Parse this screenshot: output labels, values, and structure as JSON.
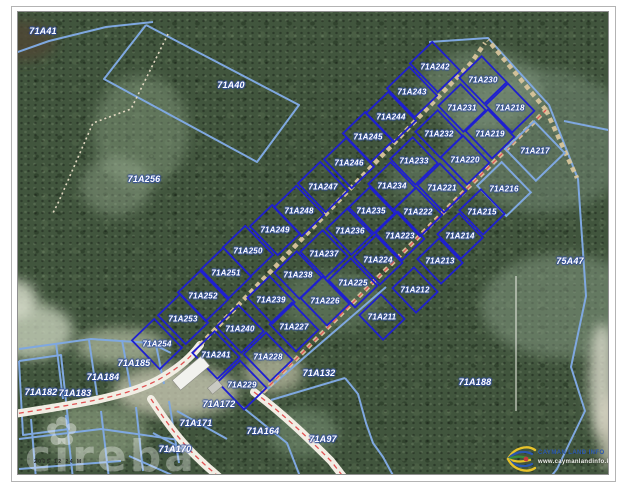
{
  "map": {
    "watermark_text": "cireba",
    "watermark_flower_icon": "flower-icon",
    "scale_text": "2005 12 24  M",
    "logo": {
      "line1": "CAYMAN LAND INFO",
      "line2": "www.caymanlandinfo.ky"
    },
    "colors": {
      "lot_blue": "#1f1fd0",
      "parcel_light_blue": "#7fa8e0",
      "road_white": "#f1eee4",
      "road_red": "#e05353",
      "track_tan": "#d8c59c",
      "label_white": "#ffffff"
    },
    "background_parcels": [
      {
        "id": "71A41",
        "x": 42,
        "y": 30
      },
      {
        "id": "71A40",
        "x": 230,
        "y": 84
      },
      {
        "id": "71A256",
        "x": 143,
        "y": 178
      },
      {
        "id": "75A47",
        "x": 569,
        "y": 260
      },
      {
        "id": "71A132",
        "x": 318,
        "y": 372
      },
      {
        "id": "71A188",
        "x": 474,
        "y": 381
      },
      {
        "id": "71A97",
        "x": 322,
        "y": 438
      },
      {
        "id": "71A185",
        "x": 133,
        "y": 362
      },
      {
        "id": "71A184",
        "x": 102,
        "y": 376
      },
      {
        "id": "71A183",
        "x": 74,
        "y": 392
      },
      {
        "id": "71A182",
        "x": 40,
        "y": 391
      },
      {
        "id": "71A172",
        "x": 218,
        "y": 403
      },
      {
        "id": "71A171",
        "x": 195,
        "y": 422
      },
      {
        "id": "71A170",
        "x": 174,
        "y": 448
      },
      {
        "id": "71A164",
        "x": 262,
        "y": 430
      }
    ],
    "subdivision": {
      "rotation_deg": -44,
      "row_sizes": {
        "1": {
          "w": 31,
          "h": 40
        },
        "2": {
          "w": 31,
          "h": 36
        },
        "3": {
          "w": 31,
          "h": 38
        },
        "4": {
          "w": 30,
          "h": 34
        }
      },
      "lots": [
        {
          "id": "71A242",
          "x": 434,
          "y": 66,
          "row": 1
        },
        {
          "id": "71A243",
          "x": 411,
          "y": 91,
          "row": 1
        },
        {
          "id": "71A244",
          "x": 390,
          "y": 116,
          "row": 1
        },
        {
          "id": "71A245",
          "x": 367,
          "y": 136,
          "row": 1
        },
        {
          "id": "71A246",
          "x": 348,
          "y": 162,
          "row": 1
        },
        {
          "id": "71A247",
          "x": 322,
          "y": 186,
          "row": 1
        },
        {
          "id": "71A248",
          "x": 298,
          "y": 210,
          "row": 1
        },
        {
          "id": "71A249",
          "x": 274,
          "y": 229,
          "row": 1
        },
        {
          "id": "71A250",
          "x": 247,
          "y": 250,
          "row": 1
        },
        {
          "id": "71A251",
          "x": 225,
          "y": 272,
          "row": 1
        },
        {
          "id": "71A252",
          "x": 202,
          "y": 295,
          "row": 1
        },
        {
          "id": "71A253",
          "x": 182,
          "y": 318,
          "row": 1
        },
        {
          "id": "71A254",
          "x": 156,
          "y": 343,
          "row": 1
        },
        {
          "id": "71A230",
          "x": 482,
          "y": 79,
          "row": 2
        },
        {
          "id": "71A231",
          "x": 461,
          "y": 107,
          "row": 2
        },
        {
          "id": "71A232",
          "x": 438,
          "y": 133,
          "row": 2
        },
        {
          "id": "71A233",
          "x": 413,
          "y": 160,
          "row": 2
        },
        {
          "id": "71A234",
          "x": 391,
          "y": 185,
          "row": 2
        },
        {
          "id": "71A235",
          "x": 370,
          "y": 210,
          "row": 2
        },
        {
          "id": "71A236",
          "x": 349,
          "y": 230,
          "row": 2
        },
        {
          "id": "71A237",
          "x": 323,
          "y": 253,
          "row": 2
        },
        {
          "id": "71A238",
          "x": 297,
          "y": 274,
          "row": 2
        },
        {
          "id": "71A239",
          "x": 270,
          "y": 299,
          "row": 2
        },
        {
          "id": "71A240",
          "x": 239,
          "y": 328,
          "row": 2
        },
        {
          "id": "71A241",
          "x": 215,
          "y": 354,
          "row": 2
        },
        {
          "id": "71A218",
          "x": 509,
          "y": 107,
          "row": 3
        },
        {
          "id": "71A219",
          "x": 489,
          "y": 133,
          "row": 3
        },
        {
          "id": "71A220",
          "x": 464,
          "y": 159,
          "row": 3
        },
        {
          "id": "71A221",
          "x": 441,
          "y": 187,
          "row": 3
        },
        {
          "id": "71A222",
          "x": 417,
          "y": 211,
          "row": 3
        },
        {
          "id": "71A223",
          "x": 399,
          "y": 235,
          "row": 3
        },
        {
          "id": "71A224",
          "x": 377,
          "y": 259,
          "row": 3
        },
        {
          "id": "71A225",
          "x": 352,
          "y": 282,
          "row": 3
        },
        {
          "id": "71A226",
          "x": 324,
          "y": 300,
          "row": 3
        },
        {
          "id": "71A227",
          "x": 293,
          "y": 326,
          "row": 3
        },
        {
          "id": "71A228",
          "x": 267,
          "y": 356,
          "row": 3
        },
        {
          "id": "71A229",
          "x": 241,
          "y": 384,
          "row": 3
        },
        {
          "id": "71A217",
          "x": 534,
          "y": 150,
          "row": 4,
          "light": true,
          "w": 40,
          "h": 44
        },
        {
          "id": "71A216",
          "x": 503,
          "y": 188,
          "row": 4,
          "light": true,
          "w": 34,
          "h": 42
        },
        {
          "id": "71A215",
          "x": 481,
          "y": 211,
          "row": 4
        },
        {
          "id": "71A214",
          "x": 459,
          "y": 235,
          "row": 4
        },
        {
          "id": "71A213",
          "x": 439,
          "y": 260,
          "row": 4
        },
        {
          "id": "71A212",
          "x": 414,
          "y": 289,
          "row": 4
        },
        {
          "id": "71A211",
          "x": 381,
          "y": 316,
          "row": 4
        }
      ]
    },
    "geometry": {
      "roads": {
        "west_road": "M 0,415 C 70,404 130,396 162,376 C 180,365 190,356 199,344",
        "south_road_1": "M 253,391 C 285,415 310,440 330,460 L 344,478",
        "south_road_2": "M 150,398 C 163,418 180,442 200,460 C 208,468 214,472 220,478",
        "track_a": "M 199,344 L 470,62 L 484,42",
        "track_b": "M 262,391 L 545,109",
        "track_tip": "M 545,109 L 487,39",
        "track_tip_se": "M 545,109 L 576,177"
      },
      "trail_nw": [
        [
          167,
          33
        ],
        [
          130,
          108
        ],
        [
          92,
          122
        ],
        [
          58,
          200
        ],
        [
          52,
          212
        ]
      ],
      "survey_line": [
        [
          515,
          275
        ],
        [
          515,
          410
        ]
      ],
      "light_polylines": [
        [
          [
            0,
            57
          ],
          [
            48,
            40
          ],
          [
            105,
            26
          ],
          [
            152,
            21
          ]
        ],
        [
          [
            145,
            24
          ],
          [
            298,
            104
          ],
          [
            256,
            161
          ],
          [
            103,
            78
          ],
          [
            145,
            24
          ]
        ],
        [
          [
            428,
            41
          ],
          [
            487,
            37
          ],
          [
            548,
            104
          ],
          [
            577,
            178
          ]
        ],
        [
          [
            563,
            120
          ],
          [
            632,
            134
          ]
        ],
        [
          [
            577,
            178
          ],
          [
            585,
            295
          ],
          [
            570,
            366
          ],
          [
            584,
            410
          ],
          [
            556,
            468
          ],
          [
            548,
            478
          ]
        ],
        [
          [
            262,
            392
          ],
          [
            385,
            286
          ]
        ],
        [
          [
            270,
            399
          ],
          [
            344,
            377
          ]
        ],
        [
          [
            344,
            377
          ],
          [
            357,
            393
          ],
          [
            365,
            422
          ],
          [
            372,
            442
          ],
          [
            382,
            456
          ],
          [
            394,
            478
          ]
        ],
        [
          [
            18,
            348
          ],
          [
            90,
            338
          ],
          [
            150,
            342
          ],
          [
            170,
            352
          ]
        ],
        [
          [
            55,
            342
          ],
          [
            62,
            398
          ]
        ],
        [
          [
            88,
            339
          ],
          [
            96,
            394
          ]
        ],
        [
          [
            121,
            339
          ],
          [
            130,
            389
          ]
        ],
        [
          [
            155,
            344
          ],
          [
            163,
            383
          ]
        ],
        [
          [
            18,
            360
          ],
          [
            60,
            354
          ],
          [
            68,
            428
          ],
          [
            22,
            434
          ],
          [
            18,
            360
          ]
        ],
        [
          [
            18,
            438
          ],
          [
            100,
            428
          ],
          [
            185,
            440
          ]
        ],
        [
          [
            30,
            418
          ],
          [
            35,
            478
          ]
        ],
        [
          [
            65,
            414
          ],
          [
            72,
            478
          ]
        ],
        [
          [
            100,
            410
          ],
          [
            108,
            478
          ]
        ],
        [
          [
            135,
            406
          ],
          [
            142,
            470
          ]
        ],
        [
          [
            168,
            400
          ],
          [
            178,
            462
          ]
        ],
        [
          [
            18,
            468
          ],
          [
            120,
            460
          ]
        ],
        [
          [
            176,
            410
          ],
          [
            226,
            438
          ]
        ],
        [
          [
            152,
            432
          ],
          [
            204,
            460
          ]
        ],
        [
          [
            128,
            455
          ],
          [
            180,
            478
          ]
        ],
        [
          [
            240,
            405
          ],
          [
            286,
            442
          ],
          [
            300,
            478
          ]
        ]
      ],
      "sand_patches": [
        {
          "cx": 30,
          "cy": 330,
          "rx": 42,
          "ry": 28,
          "c": "#cfd8c2",
          "o": 0.75
        },
        {
          "cx": 10,
          "cy": 298,
          "rx": 26,
          "ry": 20,
          "c": "#dde2d0",
          "o": 0.8
        },
        {
          "cx": 120,
          "cy": 345,
          "rx": 46,
          "ry": 18,
          "c": "#c9d0b5",
          "o": 0.6
        },
        {
          "cx": 175,
          "cy": 390,
          "rx": 62,
          "ry": 26,
          "c": "#d8d5c0",
          "o": 0.7
        },
        {
          "cx": 95,
          "cy": 432,
          "rx": 52,
          "ry": 30,
          "c": "#aebf9e",
          "o": 0.45
        },
        {
          "cx": 272,
          "cy": 372,
          "rx": 30,
          "ry": 20,
          "c": "#d5d2b8",
          "o": 0.6
        },
        {
          "cx": 302,
          "cy": 432,
          "rx": 36,
          "ry": 24,
          "c": "#8fa98c",
          "o": 0.4
        },
        {
          "cx": 140,
          "cy": 130,
          "rx": 48,
          "ry": 56,
          "c": "#9db395",
          "o": 0.35
        },
        {
          "cx": 115,
          "cy": 185,
          "rx": 36,
          "ry": 30,
          "c": "#a8bba0",
          "o": 0.35
        },
        {
          "cx": 540,
          "cy": 140,
          "rx": 92,
          "ry": 72,
          "c": "#7e9480",
          "o": 0.45
        },
        {
          "cx": 562,
          "cy": 305,
          "rx": 82,
          "ry": 52,
          "c": "#90a58e",
          "o": 0.45
        },
        {
          "cx": 480,
          "cy": 88,
          "rx": 62,
          "ry": 40,
          "c": "#8aa089",
          "o": 0.4
        },
        {
          "cx": 601,
          "cy": 380,
          "rx": 13,
          "ry": 58,
          "c": "#e8e6d8",
          "o": 0.75
        },
        {
          "cx": 608,
          "cy": 430,
          "rx": 10,
          "ry": 38,
          "c": "#dfd9c8",
          "o": 0.75
        },
        {
          "cx": 330,
          "cy": 300,
          "rx": 52,
          "ry": 30,
          "c": "#728a6e",
          "o": 0.45
        },
        {
          "cx": 430,
          "cy": 178,
          "rx": 42,
          "ry": 26,
          "c": "#7a927a",
          "o": 0.35
        },
        {
          "cx": 20,
          "cy": 40,
          "rx": 34,
          "ry": 20,
          "c": "#4f4636",
          "o": 0.85
        }
      ],
      "buildings": [
        {
          "x": 190,
          "y": 372,
          "w": 38,
          "h": 13,
          "rot": -40,
          "c": "#f2f2ee"
        },
        {
          "x": 214,
          "y": 386,
          "w": 13,
          "h": 8,
          "rot": -40,
          "c": "#c9c9c2"
        }
      ]
    }
  }
}
